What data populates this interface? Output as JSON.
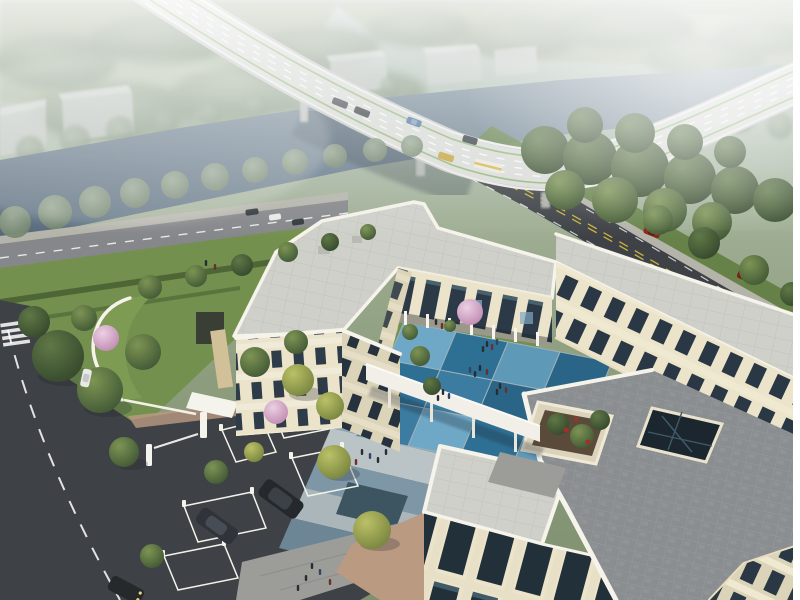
{
  "meta": {
    "type": "architectural-aerial-rendering",
    "description": "Hazy aerial rendering of a cream 3-storey campus building beside a canal; curved highway viaduct with traffic above, blue checkerboard courtyard, green-roof pavilion, grass-grid parking with gate, roof terrace with planter and glass atrium, tree-lined roads with cars and pedestrians.",
    "canvas": {
      "width": 800,
      "height": 600
    }
  },
  "palette": {
    "frame": "#ffffff",
    "field": "#9dab8f",
    "field_light": "#aab79b",
    "haze_tree": "#7c9077",
    "warehouse": "#c3c7c3",
    "warehouse_top": "#d6d9d5",
    "river_a": "#8496a3",
    "river_b": "#55687a",
    "deck": "#c9cbc7",
    "deck_top": "#dcddd9",
    "rail": "#f2f2ef",
    "lane_green": "#82ab5c",
    "lane_yellow": "#c9b23f",
    "bridge_shadow": "#2e3a47",
    "asphalt": "#3e4145",
    "asphalt_n": "#85878a",
    "sidewalk": "#b4b4aa",
    "lawn": "#74904e",
    "lawn_dark": "#617d40",
    "hedge": "#4a6234",
    "roof": "#cfd0ca",
    "parapet": "#f5f3ea",
    "cornice": "#e8ddbd",
    "terrace": "#8a8e91",
    "facade_lit": "#ece4ca",
    "facade_shade": "#dcd4b8",
    "window": "#2c3947",
    "glass": "#7fa8c2",
    "colonnade": "#f6f4ec",
    "walk": "#9c9d99",
    "tan": "#bb9a82",
    "pond": "#3c5561",
    "soil": "#5a4a3a",
    "atrium": "#1c262e",
    "atrium_mullion": "#3f5a68",
    "plaza1": "#90a7b4",
    "plaza2": "#bac3c5",
    "plaza3": "#7e97a6",
    "plaza4": "#abb6ba",
    "plaza5": "#6d8696",
    "tile_a": "#6fa8c6",
    "tile_b": "#2e6f94",
    "tile_c": "#5e9ab8",
    "tile_d": "#3c7ca0",
    "tile_e": "#2a6587",
    "tile_line": "#9db0ba",
    "lattice": "#cdd9ae",
    "lattice_rail": "#f2f4ea",
    "gate": "#f4f3ec",
    "people": "#272c31",
    "people_red": "#6b2f2c",
    "people_blue": "#2f4660",
    "car_dark": "#33383e",
    "car_cab": "#565c63",
    "car_white": "#e9eae8",
    "car_red": "#8c2418",
    "car_red2": "#7c1f15",
    "car_blue": "#4a6f9c",
    "taxi": "#c9a23a",
    "bus": "#edebe2",
    "bus_stripe": "#d8b84a",
    "tree_hi": "#7d9454",
    "tree_lo": "#3f5634",
    "bloom_red": "#a03028",
    "shadow": "#1f2631"
  },
  "scene": {
    "setting": "riverside campus at hazy daytime, bird's-eye oblique view",
    "background": {
      "forest_belts": "misty tree masses and fields",
      "warehouse_blocks": 5,
      "distant_road_vehicles": [
        {
          "type": "bus",
          "color": "#edebe2"
        },
        {
          "type": "car",
          "color": "#33383e"
        }
      ]
    },
    "river": {
      "type": "canal",
      "direction": "lower-left to upper-right",
      "banks": "tree-lined"
    },
    "bridge": {
      "type": "curved highway viaduct over canal",
      "markings": [
        "white dashed lane lines",
        "green edge lines",
        "white guard rails"
      ],
      "vehicles": [
        {
          "type": "sedan",
          "color": "#3a3f45"
        },
        {
          "type": "sedan",
          "color": "#2e3338"
        },
        {
          "type": "sedan",
          "color": "#4a6f9c"
        },
        {
          "type": "sedan",
          "color": "#343a40"
        },
        {
          "type": "taxi",
          "color": "#c9a23a"
        },
        {
          "type": "box-truck",
          "color": "#edebe2"
        }
      ]
    },
    "roads": {
      "east_road": {
        "surface": "dark asphalt",
        "center_line": "dashed yellow",
        "vehicles": [
          {
            "type": "car",
            "color": "#e9eae8"
          },
          {
            "type": "suv",
            "color": "#8c2418"
          },
          {
            "type": "suv",
            "color": "#7c1f15"
          }
        ]
      },
      "north_road": {
        "surface": "light asphalt",
        "vehicles": [
          {
            "type": "car",
            "color": "#33383e"
          },
          {
            "type": "car",
            "color": "#e9eae8"
          },
          {
            "type": "car",
            "color": "#33383e"
          }
        ]
      },
      "west_road": {
        "features": [
          "dashed white center line",
          "zebra crosswalk"
        ],
        "vehicles": [
          {
            "type": "car",
            "color": "#e9eae8"
          },
          {
            "type": "car",
            "color": "#26292c"
          }
        ]
      }
    },
    "campus": {
      "building": {
        "material": "cream stone",
        "floors": 3,
        "wings": [
          "north wing",
          "west wing",
          "east wing",
          "south block"
        ],
        "roofs": "pale pavers with white rounded parapets"
      },
      "courtyard": {
        "paving": "blue checkerboard tiles",
        "tile_grid": "4 x 3",
        "tile_colors": [
          "#6fa8c6",
          "#2e6f94",
          "#5e9ab8",
          "#2a6587",
          "#2e6f94",
          "#3c7ca0",
          "#2a6587",
          "#6fa8c6",
          "#3c7ca0",
          "#6fa8c6",
          "#2e6f94",
          "#5e9ab8"
        ],
        "features": [
          "lawn strips",
          "cherry blossom tree",
          "pedestrian groups"
        ]
      },
      "roof_terrace": {
        "features": [
          "raised planter with trees and red blooms",
          "dark glass atrium skylight",
          "white parapet"
        ]
      },
      "walkway_canopy": "white elevated connecting corridor",
      "green_roof_pavilion": "crescent grass-roofed gatehouse",
      "entrance": {
        "gate": "boom barrier with white pillars and canopy"
      },
      "parking": {
        "stall_type": "grass-grid lattice",
        "vehicles": [
          {
            "type": "suv",
            "color": "#25282c"
          },
          {
            "type": "suv",
            "color": "#30343a"
          },
          {
            "type": "suv",
            "color": "#26292c"
          }
        ]
      },
      "plaza": {
        "paving": "blue-grey banded stone",
        "extra": "dark reflecting pond"
      },
      "people_groups": [
        {
          "area": "courtyard",
          "count": 12
        },
        {
          "area": "entry plaza",
          "count": 6
        },
        {
          "area": "south walkway",
          "count": 6
        },
        {
          "area": "north lawn",
          "count": 2
        }
      ],
      "vegetation": {
        "blossom_trees": 3,
        "street_trees": true,
        "lawns": true,
        "hedges": true
      }
    },
    "frame": {
      "right_border": "white strip"
    }
  }
}
